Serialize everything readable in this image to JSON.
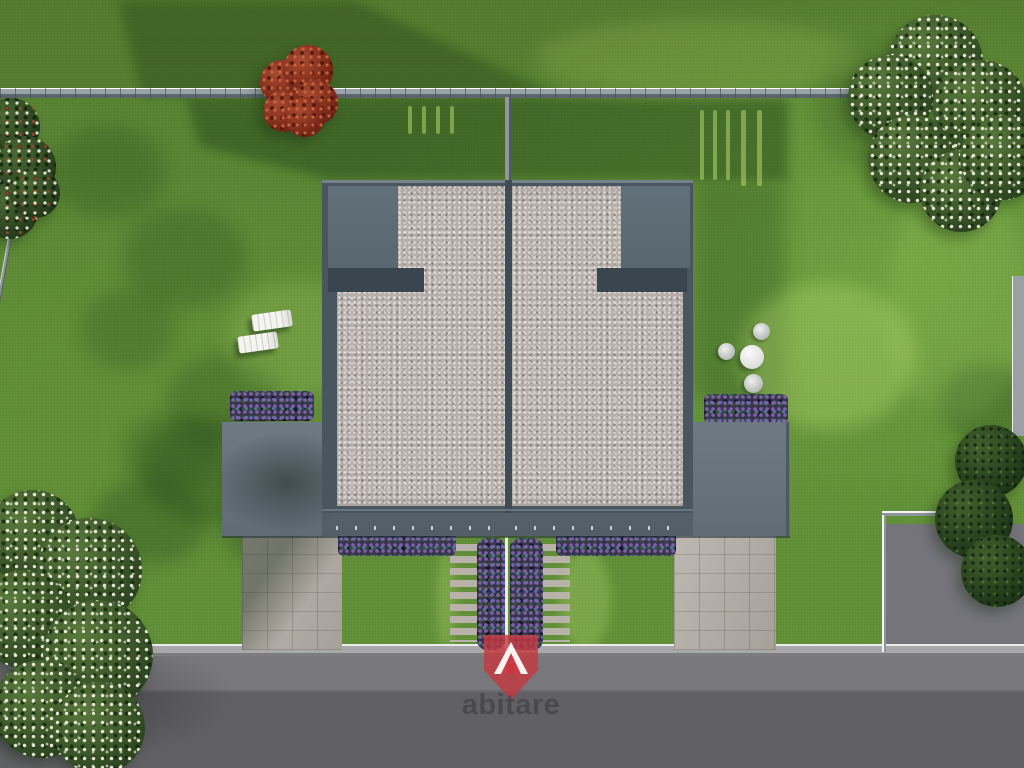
{
  "watermark": {
    "logo_text": "abitare",
    "logo_shield_color": "#c6383e",
    "logo_text_color": "#46464a"
  },
  "palette": {
    "lawn_green": "#5d8a35",
    "lawn_shadow_green": "#2e511f",
    "roof_parapet_gray": "#49565f",
    "roof_gravel_beige": "#b6aea8",
    "lower_roof_slab_gray": "#68747e",
    "road_asphalt_gray": "#69696d",
    "curb_light_gray": "#a9a9ab",
    "flower_purple": "#8063a8",
    "flower_blue": "#5476b2",
    "red_tree_foliage": "#8f2f1e",
    "green_tree_foliage": "#33522a",
    "blossom_white": "#f2f2e0",
    "fence_gray": "#9aa3a8"
  }
}
